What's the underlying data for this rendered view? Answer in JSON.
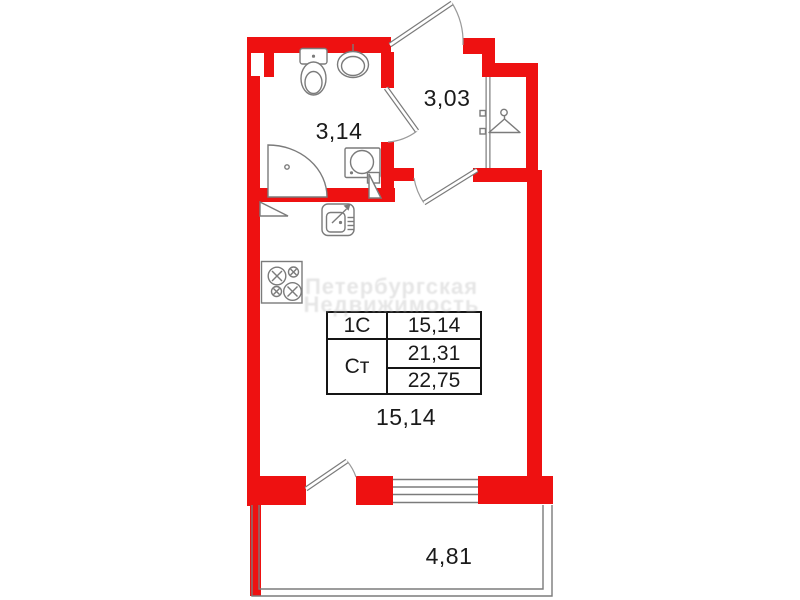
{
  "colors": {
    "wall_red": "#ee1111",
    "fixture_gray": "#7b7b7b",
    "label_black": "#1a1a1a",
    "watermark_gray": "#bdbdbd"
  },
  "rooms": {
    "bathroom": {
      "area": "3,14"
    },
    "hallway": {
      "area": "3,03"
    },
    "living_room": {
      "area": "15,14"
    },
    "balcony": {
      "area": "4,81"
    }
  },
  "area_table": {
    "row1_type": "1С",
    "row1_area": "15,14",
    "row2_type": "Ст",
    "row2_area": "21,31",
    "row3_area": "22,75"
  },
  "watermark": {
    "line1": "Петербургская",
    "line2": "Недвижимость"
  }
}
